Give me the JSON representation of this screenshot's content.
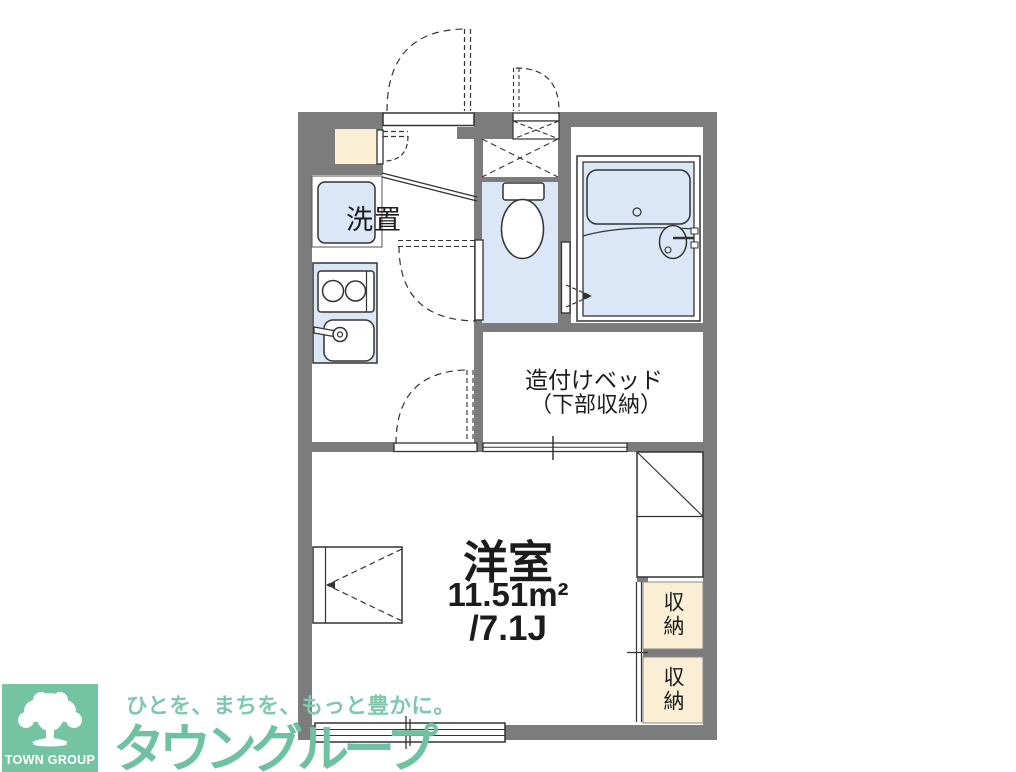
{
  "plan": {
    "rooms": {
      "laundry_label": "洗置",
      "bed_label_line1": "造付けベッド",
      "bed_label_line2": "（下部収納）",
      "main_room_name": "洋室",
      "main_room_area_sqm": "11.51m²",
      "main_room_area_tatami": "/7.1J",
      "storage_top_label": "収納",
      "storage_bottom_label": "収納"
    },
    "colors": {
      "wall_gray": "#7c7c7c",
      "water_room_blue": "#dbe7f6",
      "storage_cream": "#faefd4",
      "line_dark": "#333333"
    }
  },
  "logo": {
    "square_label": "TOWN GROUP",
    "tagline": "ひとを、まちを、もっと豊かに。",
    "brand_name": "タウングループ",
    "colors": {
      "square_green": "#74c4a3",
      "tagline_green": "#7fc8ac",
      "brand_green": "#6ec2a2"
    }
  }
}
